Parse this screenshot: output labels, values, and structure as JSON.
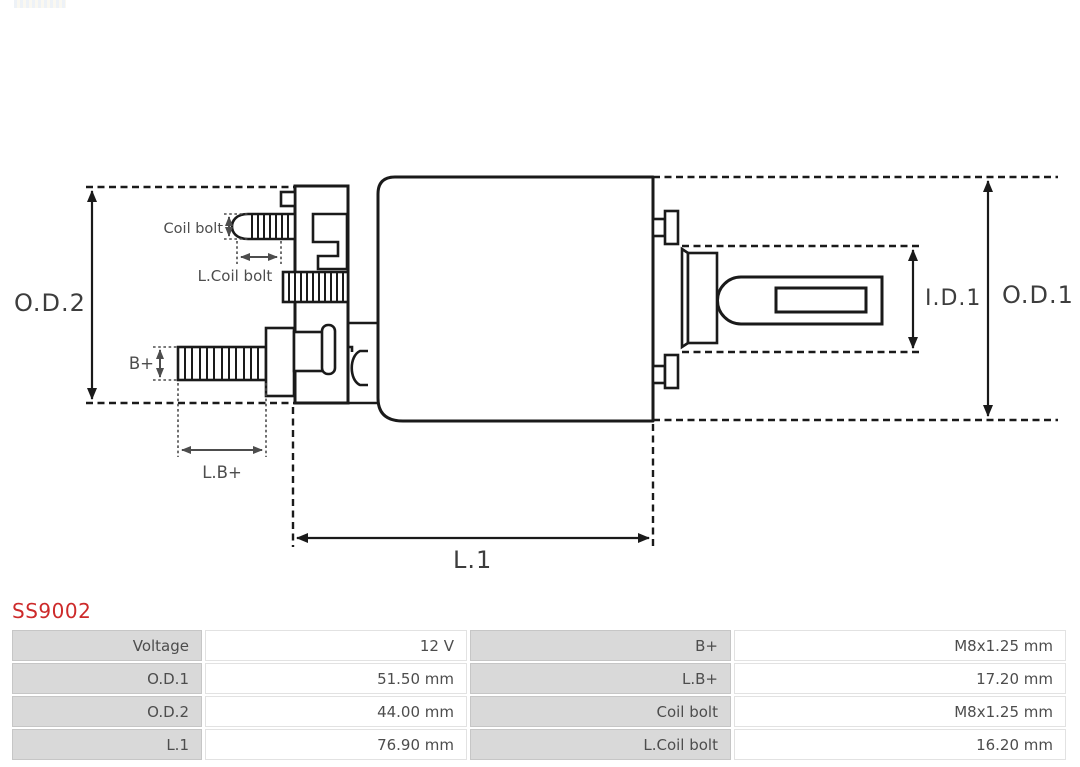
{
  "page": {
    "background": "#ffffff"
  },
  "product": {
    "code": "SS9002",
    "code_color": "#cd2a2a"
  },
  "diagram": {
    "type": "technical-drawing",
    "line_color": "#1a1a1a",
    "label_color": "#4d4d4d",
    "labels": {
      "od2": "O.D.2",
      "od1": "O.D.1",
      "id1": "I.D.1",
      "l1": "L.1",
      "coil_bolt": "Coil bolt",
      "l_coil_bolt": "L.Coil bolt",
      "b_plus": "B+",
      "l_b_plus": "L.B+"
    }
  },
  "spec_table": {
    "label_bg": "#d9d9d9",
    "text_color": "#4d4d4d",
    "rows": [
      {
        "cells": [
          "Voltage",
          "12 V",
          "B+",
          "M8x1.25 mm"
        ]
      },
      {
        "cells": [
          "O.D.1",
          "51.50 mm",
          "L.B+",
          "17.20 mm"
        ]
      },
      {
        "cells": [
          "O.D.2",
          "44.00 mm",
          "Coil bolt",
          "M8x1.25 mm"
        ]
      },
      {
        "cells": [
          "L.1",
          "76.90 mm",
          "L.Coil bolt",
          "16.20 mm"
        ]
      }
    ]
  }
}
